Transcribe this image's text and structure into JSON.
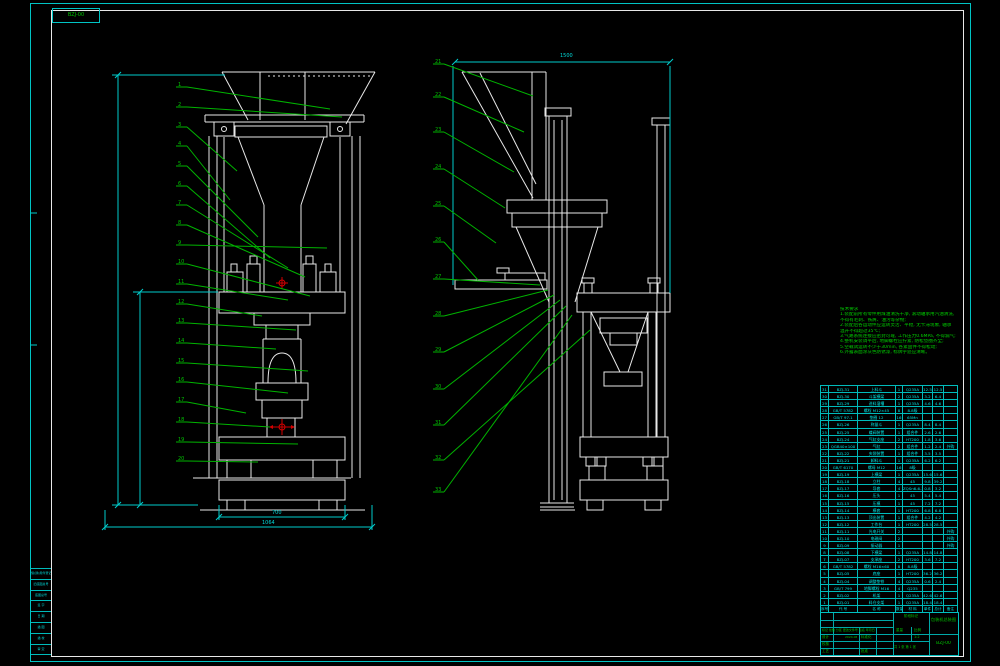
{
  "corner_label": {
    "text": "BZJ-00"
  },
  "notes": {
    "lines": [
      "技术要求",
      "1.装配前所有零件用煤油清洗干净, 滚动轴承用汽油清洗,",
      "  不得有毛刺、铁屑、油污等杂物;",
      "2.装配后各运动件应运转灵活、平稳, 无卡滞现象, 轴承",
      "  温升不得超过35℃;",
      "3.气路系统连接应密封可靠, 工作压力0.6MPa, 不得漏气;",
      "4.整机安装调平后, 地脚螺栓应拧紧, 防松垫圈齐全;",
      "5.空载试运转不少于30min, 各紧固件不得松动;",
      "6.外露表面涂灰色防锈漆, 标牌字迹应清晰。"
    ]
  },
  "dimensions": {
    "top_width": "1500",
    "inner_width": "700",
    "outer_width": "1064"
  },
  "balloons": {
    "left": [
      "1",
      "2",
      "3",
      "4",
      "5",
      "6",
      "7",
      "8",
      "9",
      "10",
      "11",
      "12",
      "13",
      "14",
      "15",
      "16",
      "17",
      "18",
      "19",
      "20"
    ],
    "right": [
      "21",
      "22",
      "23",
      "24",
      "25",
      "26",
      "27",
      "28",
      "29",
      "30",
      "31",
      "32",
      "33"
    ]
  },
  "bom": {
    "headers": [
      "序号",
      "代  号",
      "名  称",
      "数量",
      "材  料",
      "单件",
      "总计",
      "备注"
    ],
    "rows": [
      [
        "31",
        "BZJ-31",
        "上料斗",
        "1",
        "Q235A",
        "12.5",
        "12.5",
        ""
      ],
      [
        "30",
        "BZJ-30",
        "斗架横梁",
        "2",
        "Q235A",
        "3.2",
        "6.4",
        ""
      ],
      [
        "29",
        "BZJ-29",
        "进料溜槽",
        "1",
        "Q235A",
        "4.6",
        "4.6",
        ""
      ],
      [
        "28",
        "GB/T 5782",
        "螺栓 M12×45",
        "8",
        "8.8级",
        "",
        "",
        ""
      ],
      [
        "27",
        "GB/T 97.1",
        "垫圈 12",
        "16",
        "65Mn",
        "",
        "",
        ""
      ],
      [
        "26",
        "BZJ-26",
        "称量斗",
        "1",
        "Q235A",
        "8.4",
        "8.4",
        ""
      ],
      [
        "25",
        "BZJ-25",
        "蝶阀装置",
        "1",
        "组合件",
        "2.6",
        "2.6",
        ""
      ],
      [
        "24",
        "BZJ-24",
        "气缸支座",
        "2",
        "HT200",
        "1.8",
        "3.6",
        ""
      ],
      [
        "23",
        "QGB40×100",
        "气缸",
        "2",
        "组合件",
        "1.2",
        "2.4",
        "外购"
      ],
      [
        "22",
        "BZJ-22",
        "夹袋装置",
        "1",
        "组合件",
        "3.5",
        "3.5",
        ""
      ],
      [
        "21",
        "BZJ-21",
        "卸料斗",
        "1",
        "Q235A",
        "6.2",
        "6.2",
        ""
      ],
      [
        "20",
        "GB/T 6170",
        "螺母 M12",
        "16",
        "8级",
        "",
        "",
        ""
      ],
      [
        "19",
        "BZJ-19",
        "上横梁",
        "1",
        "Q235A",
        "15.6",
        "15.6",
        ""
      ],
      [
        "18",
        "BZJ-18",
        "立柱",
        "4",
        "45",
        "9.8",
        "39.2",
        ""
      ],
      [
        "17",
        "BZJ-17",
        "导套",
        "4",
        "ZQSn6-6-3",
        "0.8",
        "3.2",
        ""
      ],
      [
        "16",
        "BZJ-16",
        "压头",
        "1",
        "45",
        "5.4",
        "5.4",
        ""
      ],
      [
        "15",
        "BZJ-15",
        "压模",
        "1",
        "45",
        "7.2",
        "7.2",
        ""
      ],
      [
        "14",
        "BZJ-14",
        "模套",
        "1",
        "HT200",
        "6.8",
        "6.8",
        ""
      ],
      [
        "13",
        "BZJ-13",
        "顶出装置",
        "1",
        "组合件",
        "4.2",
        "4.2",
        ""
      ],
      [
        "12",
        "BZJ-12",
        "工作台",
        "1",
        "HT200",
        "28.5",
        "28.5",
        ""
      ],
      [
        "11",
        "BZJ-11",
        "光电开关",
        "2",
        "",
        "",
        "",
        "外购"
      ],
      [
        "10",
        "BZJ-10",
        "电磁阀",
        "2",
        "",
        "",
        "",
        "外购"
      ],
      [
        "9",
        "BZJ-09",
        "振动器",
        "1",
        "",
        "",
        "",
        "外购"
      ],
      [
        "8",
        "BZJ-08",
        "下横梁",
        "1",
        "Q235A",
        "14.8",
        "14.8",
        ""
      ],
      [
        "7",
        "BZJ-07",
        "支承座",
        "2",
        "HT200",
        "3.6",
        "7.2",
        ""
      ],
      [
        "6",
        "GB/T 5782",
        "螺栓 M16×60",
        "8",
        "8.8级",
        "",
        "",
        ""
      ],
      [
        "5",
        "BZJ-05",
        "底座",
        "1",
        "HT200",
        "36.2",
        "36.2",
        ""
      ],
      [
        "4",
        "BZJ-04",
        "调整垫铁",
        "4",
        "Q235A",
        "0.6",
        "2.4",
        ""
      ],
      [
        "3",
        "GB/T 799",
        "地脚螺栓 M16",
        "4",
        "Q235",
        "",
        "",
        ""
      ],
      [
        "2",
        "BZJ-02",
        "机架",
        "1",
        "Q235A",
        "42.6",
        "42.6",
        ""
      ],
      [
        "1",
        "BZJ-01",
        "料仓支架",
        "1",
        "Q235A",
        "18.4",
        "18.4",
        ""
      ]
    ]
  },
  "title_block": {
    "rev_row": "标记 处数 分区 更改文件号 签名 年月日",
    "design": "设计",
    "check": "校核",
    "process": "工艺",
    "standard": "标准化",
    "approve": "批准",
    "date": "2024.06",
    "stage": "阶段标记",
    "weight": "重量",
    "scale": "比例",
    "scale_value": "1:2",
    "sheets": "共 1 张 第 1 张",
    "title": "包装机总装图",
    "drawing_no": "BZJ-00"
  },
  "edge_strip": {
    "cells": [
      "借(通)用件登记",
      "旧底图总号",
      "底图总号",
      "签 字",
      "日 期",
      "描 图",
      "描 校",
      "审 定"
    ]
  },
  "colors": {
    "line": "#e8e8e8",
    "dim": "#00cccc",
    "leader": "#00b400",
    "mark": "#d40000"
  }
}
